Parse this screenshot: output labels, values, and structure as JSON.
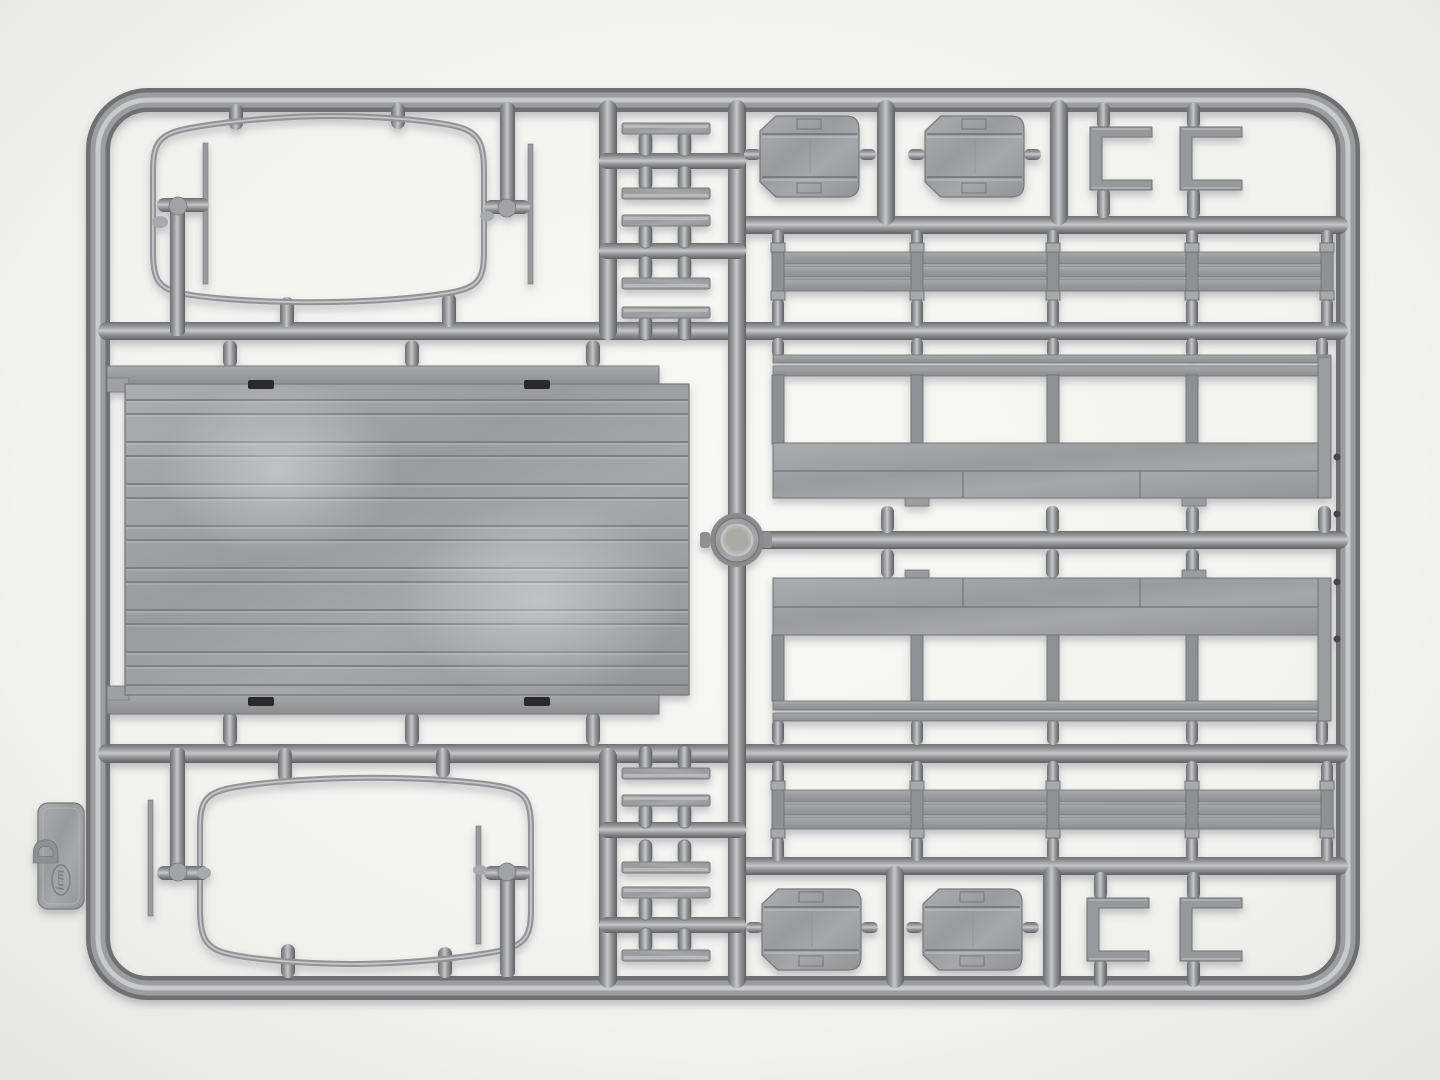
{
  "scene": {
    "subject": "photo of an injection-molded plastic model kit sprue (parts tree)",
    "background_color": "#f2f2f0",
    "plastic_mid": "#9b9c9e",
    "plastic_dark": "#6f7072",
    "plastic_light": "#c6c7c9",
    "slot_color": "#2b2b2d"
  },
  "sprue": {
    "label_tab": {
      "letter": "D",
      "brand": "icm"
    },
    "part_groups": [
      {
        "name": "canvas-bow-hoop-frame",
        "count": 2,
        "location": "left column top and bottom"
      },
      {
        "name": "planked-floor-panel",
        "count": 1,
        "location": "left center"
      },
      {
        "name": "cleat-bar",
        "count": 10,
        "location": "center column"
      },
      {
        "name": "footboard-panel",
        "count": 4,
        "location": "top and bottom rows"
      },
      {
        "name": "u-bracket",
        "count": 4,
        "location": "top right and bottom right"
      },
      {
        "name": "three-slat-side-rail",
        "count": 2,
        "location": "right side"
      },
      {
        "name": "dropside-panel-with-stakes",
        "count": 2,
        "location": "right center"
      },
      {
        "name": "injection-gate-ring",
        "count": 1,
        "location": "center"
      },
      {
        "name": "l-shaped-rod",
        "count": 4,
        "location": "inside hoop frames"
      }
    ]
  }
}
